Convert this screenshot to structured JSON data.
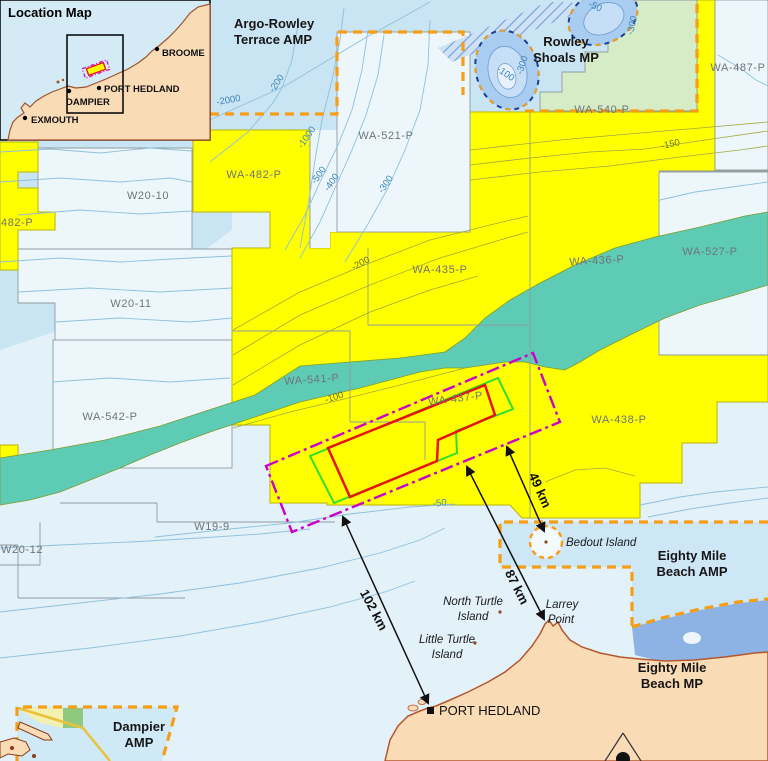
{
  "inset": {
    "title": "Location Map",
    "towns": [
      {
        "name": "BROOME",
        "dx": 157,
        "dy": 49,
        "lx": 162,
        "ly": 56
      },
      {
        "name": "PORT HEDLAND",
        "dx": 99,
        "dy": 88,
        "lx": 104,
        "ly": 92
      },
      {
        "name": "DAMPIER",
        "dx": 69,
        "dy": 91,
        "lx": 66,
        "ly": 105
      },
      {
        "name": "EXMOUTH",
        "dx": 25,
        "dy": 118,
        "lx": 31,
        "ly": 123
      }
    ]
  },
  "labels": [
    {
      "t": "482-P",
      "x": 1,
      "y": 226,
      "c": "permit",
      "a": "start",
      "n": "label-wa-482-p-west"
    },
    {
      "t": "WA-482-P",
      "x": 254,
      "y": 178,
      "c": "permit",
      "n": "label-wa-482-p"
    },
    {
      "t": "WA-521-P",
      "x": 386,
      "y": 139,
      "c": "permit",
      "n": "label-wa-521-p"
    },
    {
      "t": "WA-487-P",
      "x": 738,
      "y": 71,
      "c": "permit",
      "n": "label-wa-487-p"
    },
    {
      "t": "WA-540-P",
      "x": 602,
      "y": 113,
      "c": "permit",
      "n": "label-wa-540-p"
    },
    {
      "t": "WA-435-P",
      "x": 440,
      "y": 273,
      "c": "permit",
      "n": "label-wa-435-p"
    },
    {
      "t": "WA-436-P",
      "x": 597,
      "y": 264,
      "r": -3,
      "c": "permit",
      "n": "label-wa-436-p"
    },
    {
      "t": "WA-527-P",
      "x": 710,
      "y": 255,
      "c": "permit",
      "n": "label-wa-527-p"
    },
    {
      "t": "WA-541-P",
      "x": 312,
      "y": 383,
      "r": -4,
      "c": "permit",
      "n": "label-wa-541-p"
    },
    {
      "t": "WA-437-P",
      "x": 456,
      "y": 402,
      "r": -7,
      "c": "permit",
      "n": "label-wa-437-p"
    },
    {
      "t": "WA-438-P",
      "x": 619,
      "y": 423,
      "c": "permit",
      "n": "label-wa-438-p"
    },
    {
      "t": "WA-542-P",
      "x": 110,
      "y": 420,
      "c": "permit",
      "n": "label-wa-542-p"
    },
    {
      "t": "W20-10",
      "x": 148,
      "y": 199,
      "c": "permit",
      "n": "label-w20-10"
    },
    {
      "t": "W20-11",
      "x": 131,
      "y": 307,
      "c": "permit",
      "n": "label-w20-11"
    },
    {
      "t": "W20-12",
      "x": 1,
      "y": 553,
      "c": "permit",
      "a": "start",
      "n": "label-w20-12"
    },
    {
      "t": "W19-9",
      "x": 212,
      "y": 530,
      "c": "permit",
      "n": "label-w19-9"
    },
    {
      "t": "Argo-Rowley",
      "x": 234,
      "y": 28,
      "c": "area",
      "a": "start",
      "n": "label-argo-rowley-amp"
    },
    {
      "t": "Terrace AMP",
      "x": 234,
      "y": 44,
      "c": "area",
      "a": "start",
      "n": "label-argo-rowley-amp-2"
    },
    {
      "t": "Rowley",
      "x": 566,
      "y": 46,
      "c": "area",
      "n": "label-rowley-shoals-mp"
    },
    {
      "t": "Shoals MP",
      "x": 566,
      "y": 62,
      "c": "area",
      "n": "label-rowley-shoals-mp-2"
    },
    {
      "t": "Eighty Mile",
      "x": 692,
      "y": 560,
      "c": "area",
      "n": "label-eighty-mile-beach-amp"
    },
    {
      "t": "Beach AMP",
      "x": 692,
      "y": 576,
      "c": "area",
      "n": "label-eighty-mile-beach-amp-2"
    },
    {
      "t": "Eighty Mile",
      "x": 672,
      "y": 672,
      "c": "area",
      "n": "label-eighty-mile-beach-mp"
    },
    {
      "t": "Beach MP",
      "x": 672,
      "y": 688,
      "c": "area",
      "n": "label-eighty-mile-beach-mp-2"
    },
    {
      "t": "Dampier",
      "x": 139,
      "y": 731,
      "c": "area",
      "n": "label-dampier-amp"
    },
    {
      "t": "AMP",
      "x": 139,
      "y": 747,
      "c": "area",
      "n": "label-dampier-amp-2"
    },
    {
      "t": "Bedout Island",
      "x": 566,
      "y": 546,
      "c": "place",
      "a": "start",
      "n": "label-bedout-island"
    },
    {
      "t": "North Turtle",
      "x": 473,
      "y": 605,
      "c": "place",
      "n": "label-north-turtle-island"
    },
    {
      "t": "Island",
      "x": 473,
      "y": 620,
      "c": "place",
      "n": "label-north-turtle-island-2"
    },
    {
      "t": "Little Turtle",
      "x": 447,
      "y": 643,
      "c": "place",
      "n": "label-little-turtle-island"
    },
    {
      "t": "Island",
      "x": 447,
      "y": 658,
      "c": "place",
      "n": "label-little-turtle-island-2"
    },
    {
      "t": "Larrey",
      "x": 562,
      "y": 608,
      "c": "place",
      "n": "label-larrey-point"
    },
    {
      "t": "Point",
      "x": 561,
      "y": 623,
      "c": "place",
      "n": "label-larrey-point-2"
    },
    {
      "t": "PORT HEDLAND",
      "x": 439,
      "y": 715,
      "c": "town",
      "a": "start",
      "n": "label-port-hedland"
    },
    {
      "t": "-2000",
      "x": 229,
      "y": 103,
      "r": -10,
      "c": "cblue",
      "n": "contour-label-2000"
    },
    {
      "t": "-200",
      "x": 279,
      "y": 85,
      "r": -55,
      "c": "cblue",
      "n": "contour-label-200"
    },
    {
      "t": "-1000",
      "x": 309,
      "y": 139,
      "r": -55,
      "c": "cblue",
      "n": "contour-label-1000"
    },
    {
      "t": "-500",
      "x": 321,
      "y": 177,
      "r": -55,
      "c": "cblue",
      "n": "contour-label-500"
    },
    {
      "t": "-400",
      "x": 334,
      "y": 184,
      "r": -55,
      "c": "cblue",
      "n": "contour-label-400"
    },
    {
      "t": "-300",
      "x": 388,
      "y": 186,
      "r": -55,
      "c": "cblue",
      "n": "contour-label-300"
    },
    {
      "t": "-100",
      "x": 504,
      "y": 76,
      "r": 35,
      "c": "cblue",
      "n": "contour-label-reef-100"
    },
    {
      "t": "-300",
      "x": 525,
      "y": 66,
      "r": -72,
      "c": "cblue",
      "n": "contour-label-reef-300"
    },
    {
      "t": "-50",
      "x": 594,
      "y": 9,
      "r": 25,
      "c": "cblue",
      "n": "contour-label-reef-50"
    },
    {
      "t": "-300",
      "x": 635,
      "y": 26,
      "r": -78,
      "c": "cblue",
      "n": "contour-label-reef2-300"
    },
    {
      "t": "-50",
      "x": 440,
      "y": 506,
      "r": -5,
      "c": "cblue",
      "n": "contour-label-50"
    },
    {
      "t": "-150",
      "x": 671,
      "y": 147,
      "r": -12,
      "c": "colive",
      "n": "contour-label-150"
    },
    {
      "t": "-200",
      "x": 362,
      "y": 266,
      "r": -28,
      "c": "colive",
      "n": "contour-label-olive-200"
    },
    {
      "t": "-100",
      "x": 335,
      "y": 400,
      "r": -18,
      "c": "colive",
      "n": "contour-label-olive-100"
    }
  ],
  "arrows": [
    {
      "t": "102 km",
      "x1": 343,
      "y1": 517,
      "x2": 428,
      "y2": 703,
      "lx": 370,
      "ly": 612,
      "r": 62,
      "n": "distance-102km"
    },
    {
      "t": "87 km",
      "x1": 467,
      "y1": 467,
      "x2": 544,
      "y2": 619,
      "lx": 513,
      "ly": 589,
      "r": 63,
      "n": "distance-87km"
    },
    {
      "t": "49 km",
      "x1": 507,
      "y1": 447,
      "x2": 544,
      "y2": 531,
      "lx": 536,
      "ly": 492,
      "r": 66,
      "n": "distance-49km"
    }
  ],
  "colors": {
    "ocean": "#e3f1f8",
    "deep_water": "#c9e4f2",
    "block_pale": "#edf7fb",
    "permit_yellow": "#ffff00",
    "shoal_teal": "#5ecbb4",
    "mp_green": "#d6ecc6",
    "reef_blue": "#a9ccf1",
    "amp_orange": "#f59e16",
    "application_magenta": "#cc00cc",
    "permit_red": "#e81313",
    "permit_green": "#2ee02e",
    "land": "#f9dcb6",
    "coast": "#b5562e",
    "mp_strip_blue": "#8cb3e4"
  }
}
